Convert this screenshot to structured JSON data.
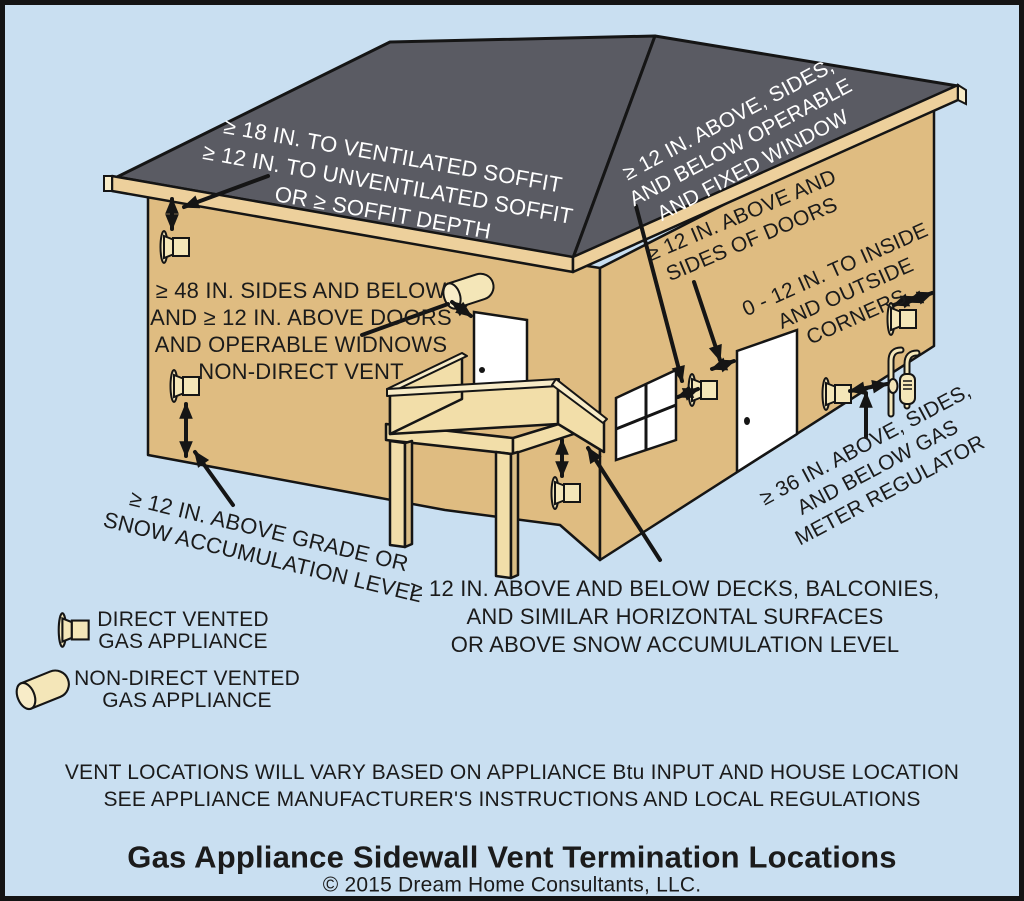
{
  "diagram": {
    "annotations": {
      "soffit": {
        "lines": [
          "≥ 18 IN. TO VENTILATED SOFFIT",
          "≥ 12 IN. TO UNVENTILATED SOFFIT",
          "OR ≥ SOFFIT DEPTH"
        ]
      },
      "window": {
        "lines": [
          "≥ 12 IN. ABOVE, SIDES,",
          "AND BELOW OPERABLE",
          "AND FIXED WINDOW"
        ]
      },
      "doors": {
        "lines": [
          "≥ 12 IN. ABOVE AND",
          "SIDES OF DOORS"
        ]
      },
      "corners": {
        "lines": [
          "0 - 12 IN. TO INSIDE",
          "AND OUTSIDE",
          "CORNERS"
        ]
      },
      "gas_meter": {
        "lines": [
          "≥ 36 IN. ABOVE, SIDES,",
          "AND BELOW GAS",
          "METER REGULATOR"
        ]
      },
      "non_direct": {
        "lines": [
          "≥ 48 IN. SIDES AND BELOW",
          "AND ≥ 12 IN. ABOVE DOORS",
          "AND OPERABLE WIDNOWS",
          "NON-DIRECT VENT"
        ]
      },
      "grade": {
        "lines": [
          "≥ 12 IN. ABOVE GRADE OR",
          "SNOW ACCUMULATION LEVEL"
        ]
      },
      "deck": {
        "lines": [
          "≥ 12 IN. ABOVE AND BELOW DECKS, BALCONIES,",
          "AND SIMILAR HORIZONTAL SURFACES",
          "OR ABOVE SNOW ACCUMULATION LEVEL"
        ]
      }
    },
    "legend": {
      "items": [
        {
          "icon": "direct-vent-icon",
          "label_lines": [
            "DIRECT VENTED",
            "GAS APPLIANCE"
          ]
        },
        {
          "icon": "non-direct-vent-icon",
          "label_lines": [
            "NON-DIRECT VENTED",
            "GAS APPLIANCE"
          ]
        }
      ]
    },
    "footer": {
      "notes": [
        "VENT LOCATIONS WILL VARY BASED ON APPLIANCE Btu INPUT AND HOUSE LOCATION",
        "SEE APPLIANCE MANUFACTURER'S INSTRUCTIONS AND LOCAL REGULATIONS"
      ],
      "title": "Gas Appliance Sidewall Vent Termination Locations",
      "copyright": "© 2015 Dream Home Consultants, LLC."
    }
  },
  "colors": {
    "sky": "#c9dff1",
    "wall": "#dfbc81",
    "roof": "#5a5b63",
    "fascia": "#edd09c",
    "deck": "#f2dea9",
    "deck_cap": "#f8ecc8",
    "vent_cream": "#f4e6b8",
    "shade": "#d9bd85",
    "outline": "#151515",
    "white_text": "#ffffff",
    "dark_text": "#1b1b1b"
  }
}
